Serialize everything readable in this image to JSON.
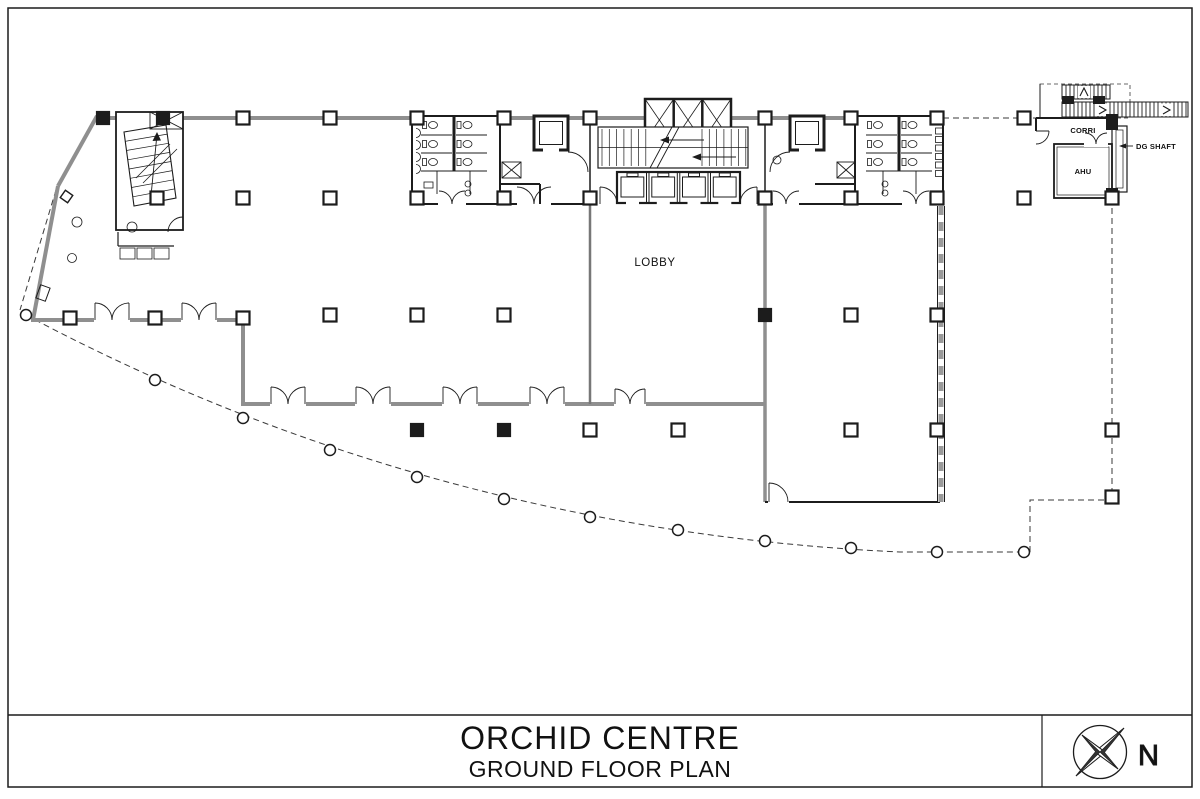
{
  "title_block": {
    "project_name": "ORCHID CENTRE",
    "drawing_name": "GROUND FLOOR PLAN"
  },
  "compass": {
    "north_label": "N"
  },
  "room_labels": {
    "lobby": "LOBBY",
    "corridor": "CORRI",
    "ahu": "AHU",
    "dg_shaft": "DG SHAFT"
  },
  "colors": {
    "background": "#ffffff",
    "wall_gray": "#8f8f8f",
    "line_black": "#1c1c1c"
  }
}
